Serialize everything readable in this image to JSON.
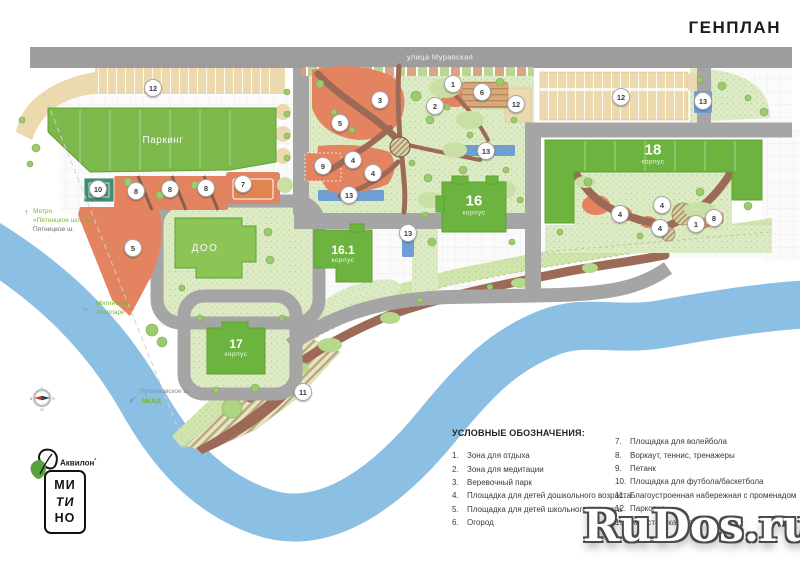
{
  "title": "ГЕНПЛАН",
  "watermark": "RuDos.ru",
  "map": {
    "street_label": "улица Муравская",
    "buildings": {
      "parking": {
        "label": "Паркинг"
      },
      "doo": {
        "label": "ДОО"
      },
      "b16": {
        "num": "16",
        "sub": "корпус"
      },
      "b161": {
        "num": "16.1",
        "sub": "корпус"
      },
      "b17": {
        "num": "17",
        "sub": "корпус"
      },
      "b18": {
        "num": "18",
        "sub": "корпус"
      }
    },
    "labels": {
      "metro_line1": "Метро",
      "metro_line2": "«Пятницкое шоссе»",
      "metro_arrow": "↑",
      "pyatnitskoe": "Пятницкое ш.",
      "lesopark_line1": "Митинский",
      "lesopark_line2": "лесопарк",
      "lesopark_arrow": "←",
      "putilkovskoe": "Путилковское ш.",
      "mkad": "МКАД",
      "mkad_arrow": "↙"
    },
    "markers": [
      {
        "n": "12",
        "x": 153,
        "y": 88
      },
      {
        "n": "10",
        "x": 98,
        "y": 189
      },
      {
        "n": "8",
        "x": 136,
        "y": 191
      },
      {
        "n": "8",
        "x": 170,
        "y": 189
      },
      {
        "n": "8",
        "x": 206,
        "y": 188
      },
      {
        "n": "7",
        "x": 243,
        "y": 184
      },
      {
        "n": "5",
        "x": 133,
        "y": 248
      },
      {
        "n": "3",
        "x": 380,
        "y": 100
      },
      {
        "n": "5",
        "x": 340,
        "y": 123
      },
      {
        "n": "1",
        "x": 453,
        "y": 84
      },
      {
        "n": "2",
        "x": 435,
        "y": 106
      },
      {
        "n": "6",
        "x": 482,
        "y": 92
      },
      {
        "n": "12",
        "x": 516,
        "y": 104
      },
      {
        "n": "9",
        "x": 323,
        "y": 166
      },
      {
        "n": "4",
        "x": 353,
        "y": 160
      },
      {
        "n": "4",
        "x": 373,
        "y": 173
      },
      {
        "n": "13",
        "x": 349,
        "y": 195
      },
      {
        "n": "13",
        "x": 408,
        "y": 233
      },
      {
        "n": "13",
        "x": 486,
        "y": 151
      },
      {
        "n": "12",
        "x": 621,
        "y": 97
      },
      {
        "n": "13",
        "x": 703,
        "y": 101
      },
      {
        "n": "4",
        "x": 620,
        "y": 214
      },
      {
        "n": "4",
        "x": 662,
        "y": 205
      },
      {
        "n": "4",
        "x": 660,
        "y": 228
      },
      {
        "n": "1",
        "x": 696,
        "y": 224
      },
      {
        "n": "8",
        "x": 714,
        "y": 218
      },
      {
        "n": "11",
        "x": 303,
        "y": 392
      }
    ]
  },
  "legend": {
    "title": "УСЛОВНЫЕ ОБОЗНАЧЕНИЯ:",
    "columns": [
      [
        {
          "n": "1.",
          "text": "Зона для отдыха"
        },
        {
          "n": "2.",
          "text": "Зона для медитации"
        },
        {
          "n": "3.",
          "text": "Веревочный парк"
        },
        {
          "n": "4.",
          "text": "Площадка для детей дошкольного возраста"
        },
        {
          "n": "5.",
          "text": "Площадка для детей школьного возраста"
        },
        {
          "n": "6.",
          "text": "Огород"
        }
      ],
      [
        {
          "n": "7.",
          "text": "Площадка для волейбола"
        },
        {
          "n": "8.",
          "text": "Воркаут, теннис, тренажеры"
        },
        {
          "n": "9.",
          "text": "Петанк"
        },
        {
          "n": "10.",
          "text": "Площадка для футбола/баскетбола"
        },
        {
          "n": "11.",
          "text": "Благоустроенная набережная с променадом"
        },
        {
          "n": "12.",
          "text": "Парковка"
        },
        {
          "n": "13.",
          "text": "Автостоянка для МГН"
        }
      ]
    ]
  },
  "logo": {
    "brand": "Аквилон",
    "mark": "°",
    "district": [
      "МИ",
      "ТИ",
      "НО"
    ]
  },
  "compass": {
    "top": "с",
    "bottom": "ю",
    "left": "з",
    "right": "в"
  },
  "colors": {
    "building_green": "#6db33f",
    "doo_green": "#8cc556",
    "lawn": "#dcebc4",
    "salmon": "#e48360",
    "road_gray": "#a5a5a5",
    "river_blue": "#8cbfe4",
    "parking_beige": "#ecd9ad",
    "parking_blue": "#6f9ed2",
    "path_brown": "#9c6a56",
    "accent_green_text": "#76b82a"
  }
}
